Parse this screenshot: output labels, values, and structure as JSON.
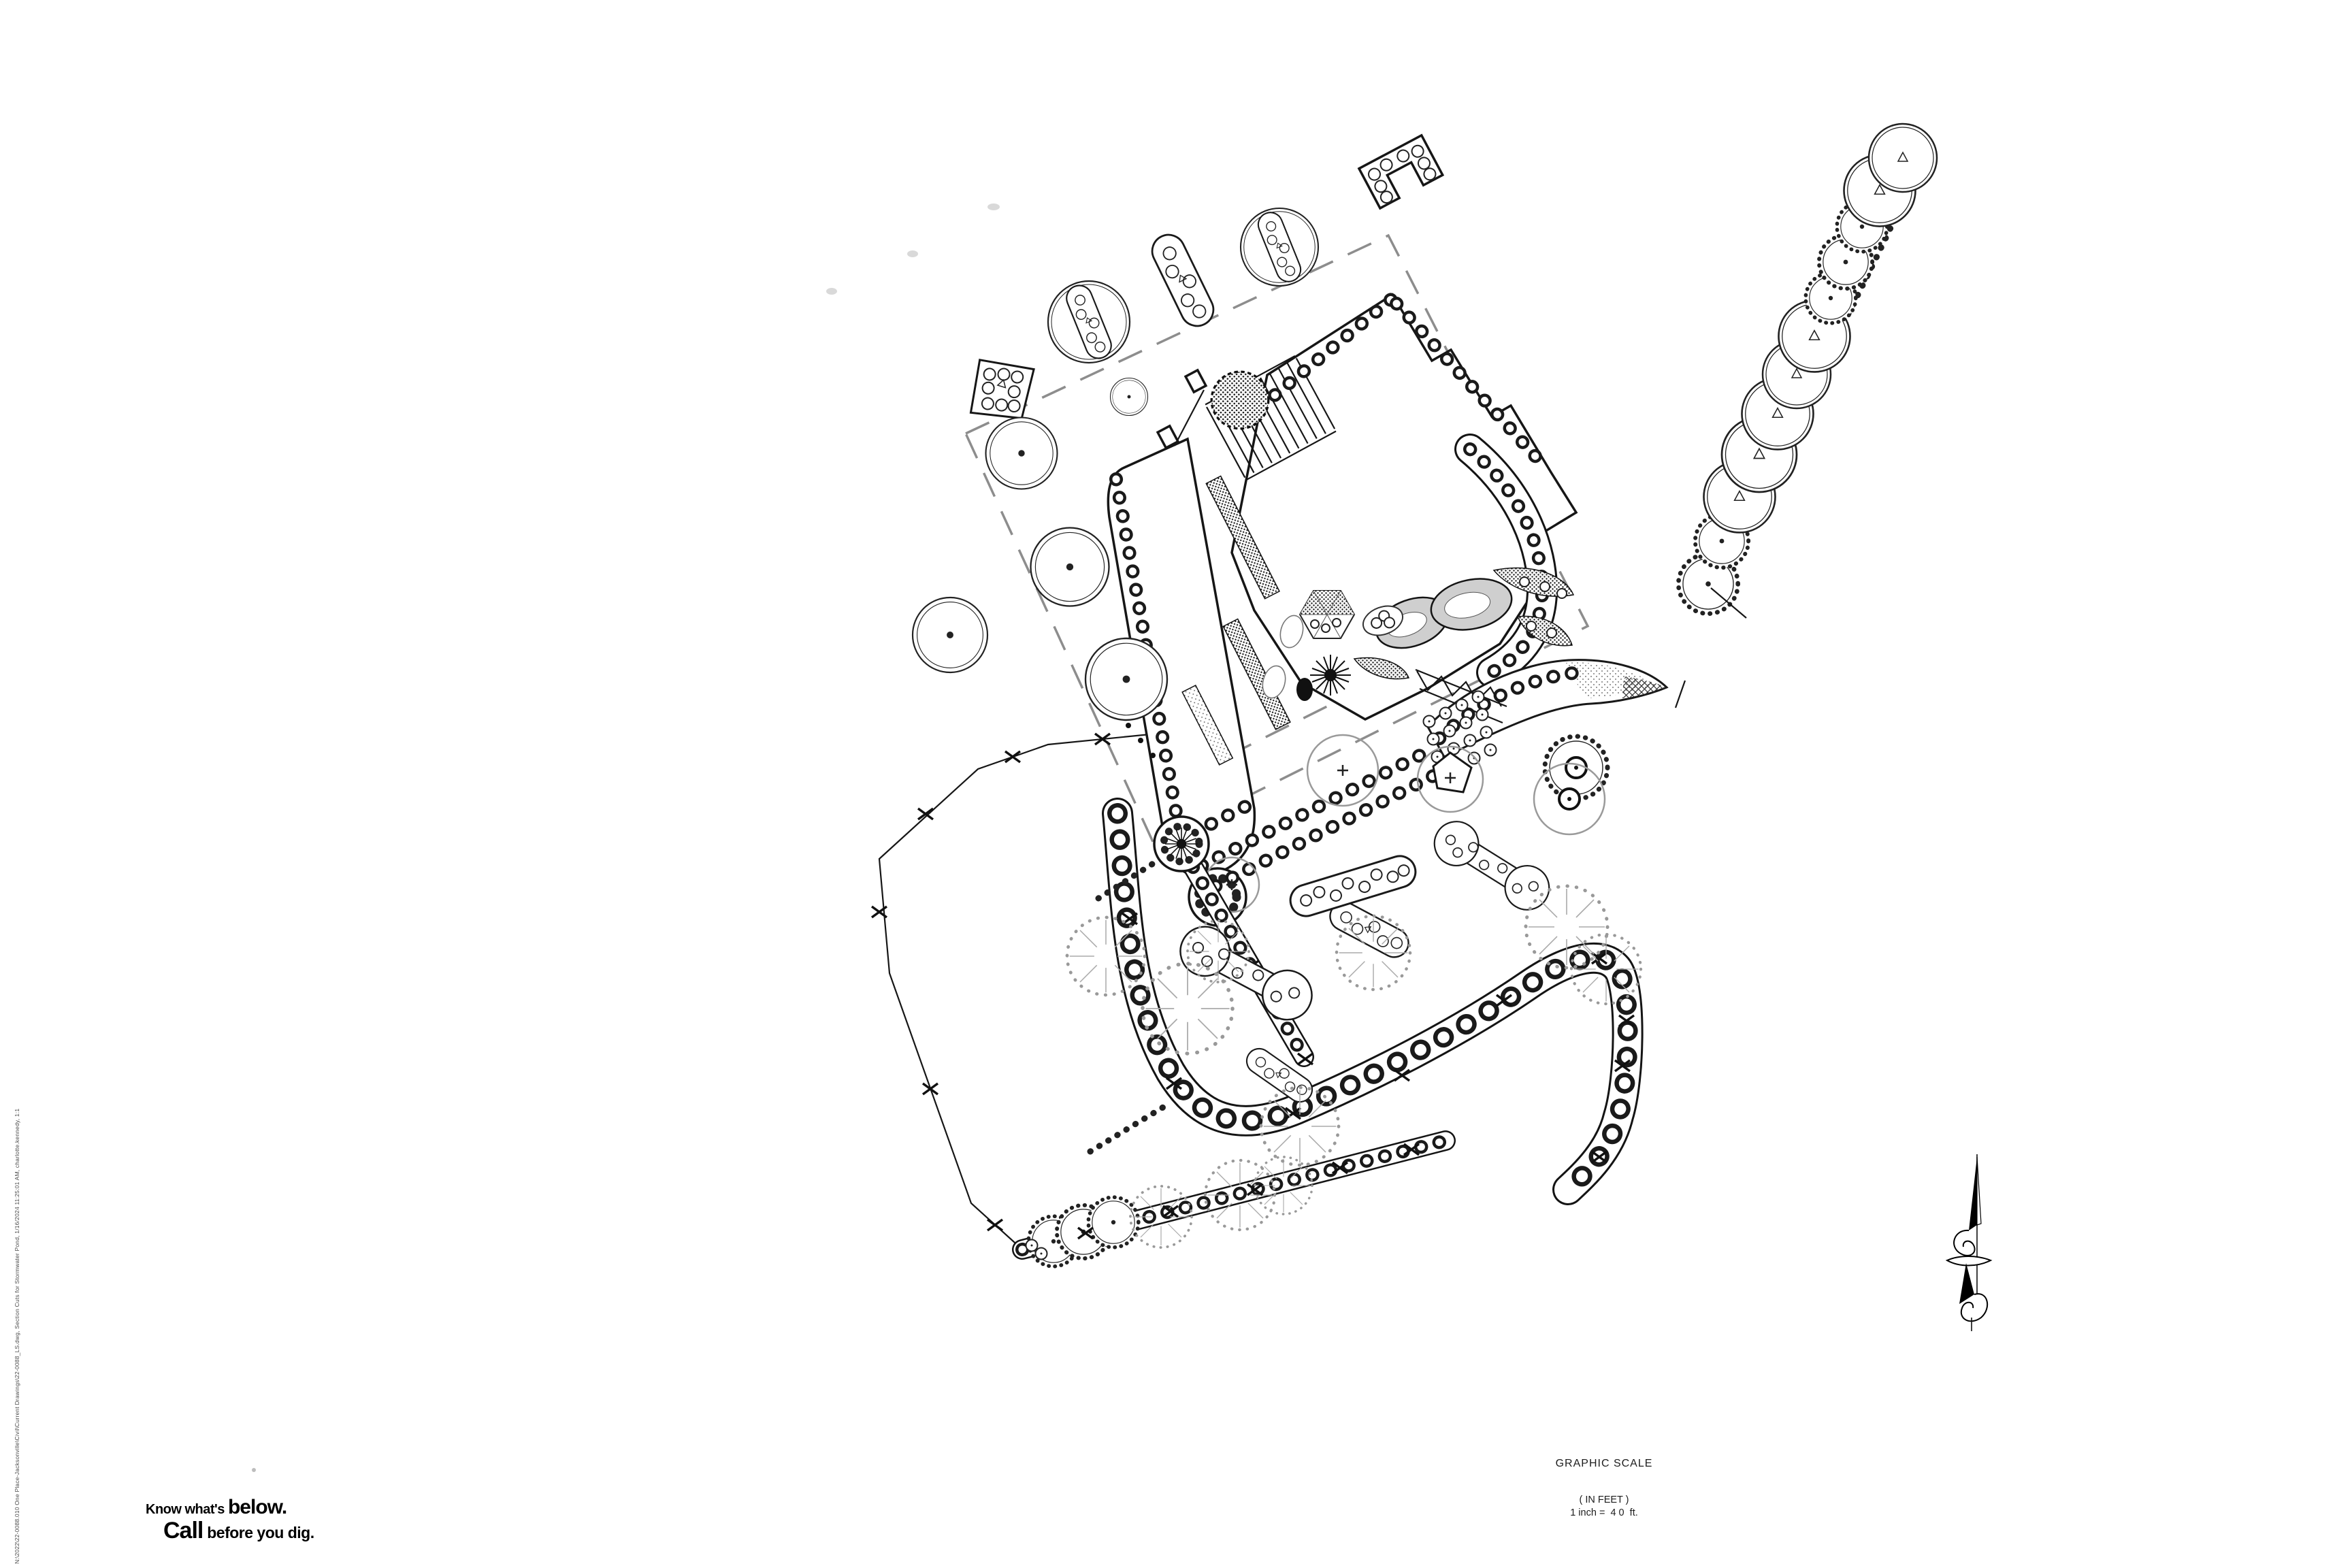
{
  "annotations": {
    "graphic_scale_title": "GRAPHIC SCALE",
    "scale_units": "( IN FEET )",
    "scale_equation": "1 inch =  4 0  ft."
  },
  "call811": {
    "know": "Know what's ",
    "below": "below.",
    "call": "Call",
    "before": " before you dig."
  },
  "plot_stamp": "N:\\2022\\22-0088.010 One Place-Jacksonville\\Civil\\Current Drawings\\22-0088_LS.dwg, Section Cuts for Stormwater Pond, 1/16/2024 11:25:01 AM, charlotte.kennedy, 1:1",
  "colors": {
    "ink": "#161616",
    "boundary_dash_gray": "#8d8d8d",
    "existing_canopy_gray": "#9a9a9a",
    "faint_artifact": "#d9d9d9",
    "paper": "#ffffff"
  },
  "symbols": [
    {
      "name": "property-line-dashed"
    },
    {
      "name": "building-footprint"
    },
    {
      "name": "entry-stairs"
    },
    {
      "name": "deciduous-tree-icon"
    },
    {
      "name": "scalloped-evergreen-tree-icon"
    },
    {
      "name": "existing-tree-canopy-icon"
    },
    {
      "name": "shrub-pod-planter-icon"
    },
    {
      "name": "planting-strip-shrub-row"
    },
    {
      "name": "stormwater-pond"
    },
    {
      "name": "chain-link-fence-x"
    },
    {
      "name": "north-arrow-icon"
    }
  ]
}
